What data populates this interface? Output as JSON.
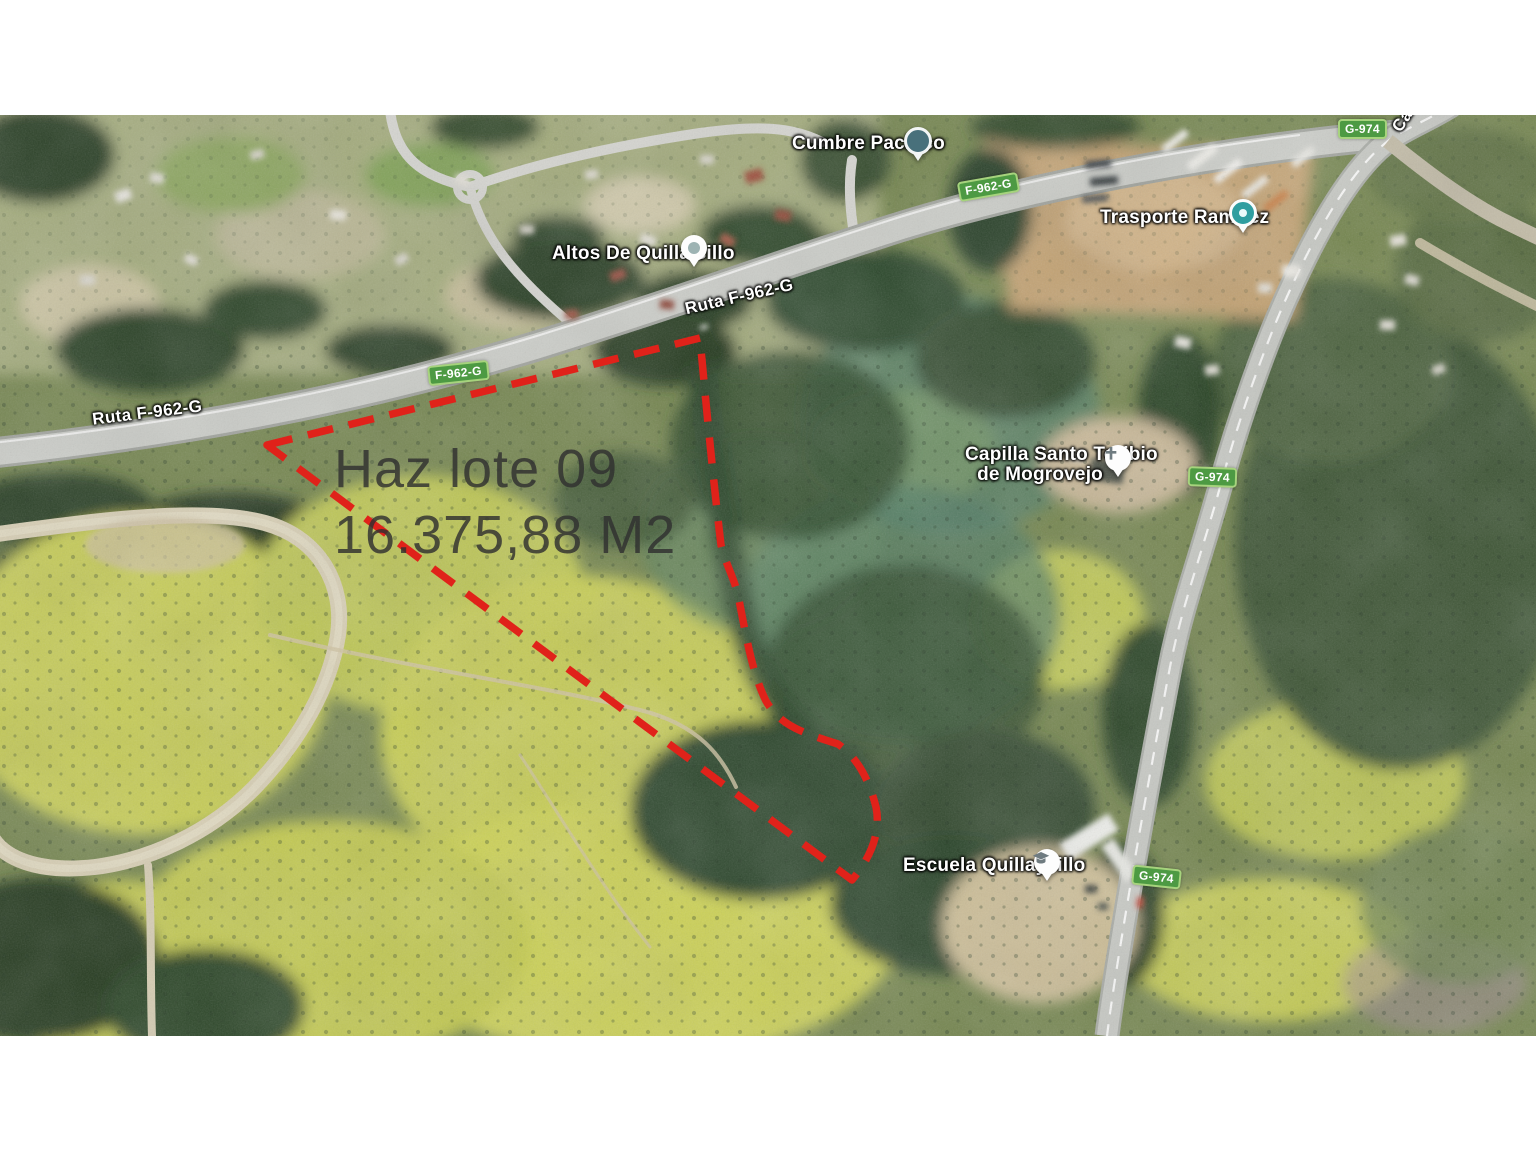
{
  "map": {
    "poi": {
      "cumbre_pacifico": "Cumbre Pacifico",
      "altos_de_quillaicillo": "Altos De Quillaicillo",
      "trasporte_ramirez": "Trasporte Ramírez",
      "capilla_line1": "Capilla Santo Toribio",
      "capilla_line2": "de Mogrovejo",
      "escuela_quillaycillo": "Escuela Quillaycillo"
    },
    "roads": {
      "ruta_f962g": "Ruta F-962-G",
      "caletera": "Caletera",
      "shield_f962g": "F-962-G",
      "shield_g974": "G-974"
    },
    "lot": {
      "title": "Haz lote 09",
      "area": "16.375,88 M2"
    },
    "colors": {
      "boundary": "#e0221a",
      "shield_bg": "#4d9a43",
      "shield_border": "#a6d37d",
      "label_text": "#ffffff",
      "lot_text": "#303030"
    }
  }
}
